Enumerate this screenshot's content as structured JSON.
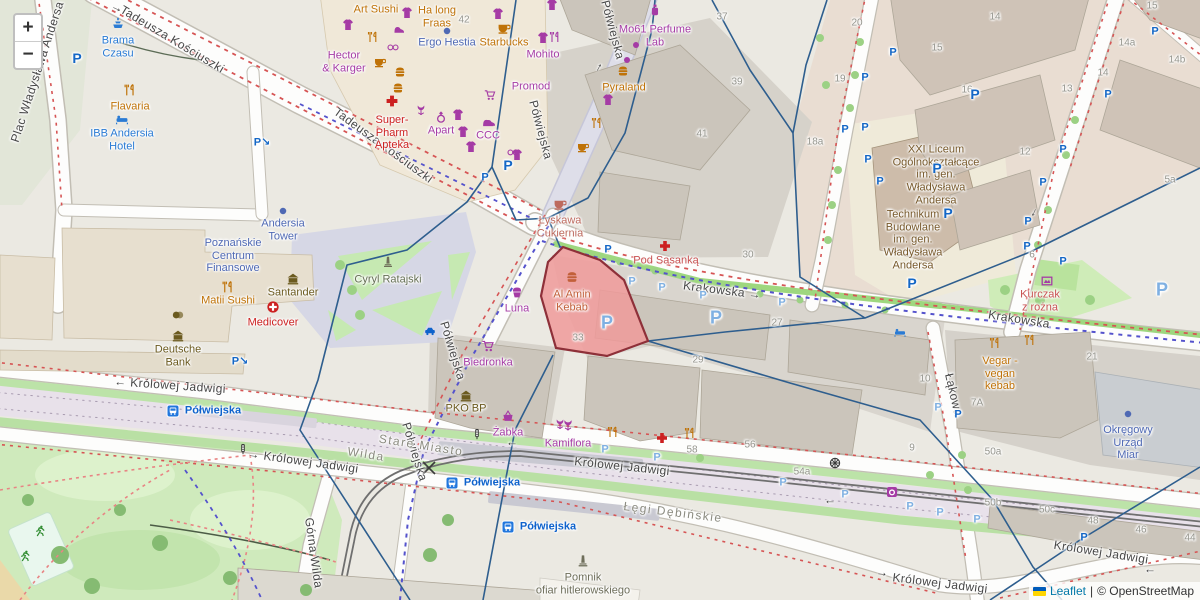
{
  "controls": {
    "zoom_in": "+",
    "zoom_out": "−"
  },
  "attribution": {
    "leaflet": "Leaflet",
    "separator": "|",
    "osm": "© OpenStreetMap",
    "flag_top": "#005bbb",
    "flag_bottom": "#ffd500"
  },
  "colors": {
    "shop": "#a53ba5",
    "food": "#bf7207",
    "health": "#cc2020",
    "hotel": "#2a7bd4",
    "attraction": "#2a7bd4",
    "office": "#4f69b4",
    "bank": "#6b5a1f",
    "school": "#77592b",
    "monument": "#6e6e5a",
    "transit": "#0e62cc",
    "plaza": "#667055",
    "resto2": "#c85252",
    "kebab": "#c2603a",
    "confection": "#bd6a5e",
    "parkfit": "#2e8b2e",
    "dark": "#3a3a3a",
    "street_label": "#474747",
    "district_label": "#8b8b80",
    "housenum": "#95958d",
    "parking": "#1467c6",
    "parking_light": "#7fb0e2",
    "boundary": "#2e5e8e",
    "highlight_fill": "#f09a9a",
    "highlight_stroke": "#8e3039",
    "route_red": "#d65454",
    "route_blue": "#5452cc"
  },
  "streets": [
    {
      "t": "Plac Władysława Andersa",
      "x": 38,
      "y": 72,
      "r": -72
    },
    {
      "t": "Tadeusza Kościuszki",
      "x": 172,
      "y": 40,
      "r": 31
    },
    {
      "t": "Tadeusza Kościuszki",
      "x": 383,
      "y": 146,
      "r": 36
    },
    {
      "t": "Półwiejska",
      "x": 612,
      "y": 30,
      "r": 75
    },
    {
      "t": "Półwiejska",
      "x": 540,
      "y": 130,
      "r": 75
    },
    {
      "t": "Krakowska →",
      "x": 722,
      "y": 291,
      "r": 7
    },
    {
      "t": "Krakowska",
      "x": 1019,
      "y": 320,
      "r": 9
    },
    {
      "t": "← Królowej Jadwigi",
      "x": 170,
      "y": 386,
      "r": 4
    },
    {
      "t": "→ Królowej Jadwigi",
      "x": 303,
      "y": 462,
      "r": 8
    },
    {
      "t": "Królowej Jadwigi",
      "x": 622,
      "y": 467,
      "r": 6
    },
    {
      "t": "Królowej Jadwigi",
      "x": 940,
      "y": 584,
      "r": 7
    },
    {
      "t": "Królowej Jadwigi",
      "x": 1101,
      "y": 553,
      "r": 9
    },
    {
      "t": "Półwiejska",
      "x": 452,
      "y": 351,
      "r": 73
    },
    {
      "t": "Półwiejska",
      "x": 414,
      "y": 452,
      "r": 73
    },
    {
      "t": "Łąkowa",
      "x": 953,
      "y": 395,
      "r": 77
    },
    {
      "t": "Górna Wilda",
      "x": 313,
      "y": 553,
      "r": 82
    }
  ],
  "districts": [
    {
      "t": "Stare Miasto",
      "x": 421,
      "y": 446,
      "r": 9
    },
    {
      "t": "Wilda",
      "x": 366,
      "y": 455,
      "r": 9
    },
    {
      "t": "Łęgi Dębińskie",
      "x": 673,
      "y": 513,
      "r": 7
    }
  ],
  "transit_stops": [
    {
      "t": "Półwiejska",
      "x": 213,
      "y": 411
    },
    {
      "t": "Półwiejska",
      "x": 492,
      "y": 483
    },
    {
      "t": "Półwiejska",
      "x": 548,
      "y": 527
    }
  ],
  "pois": [
    {
      "n": "Brama\nCzasu",
      "x": 118,
      "y": 47,
      "c": "attraction",
      "i": "fountain",
      "iy": -24
    },
    {
      "n": "Flavaria",
      "x": 130,
      "y": 107,
      "c": "food",
      "i": "cutlery",
      "iy": -17
    },
    {
      "n": "IBB Andersia\nHotel",
      "x": 122,
      "y": 140,
      "c": "hotel",
      "i": "bed",
      "iy": -21
    },
    {
      "n": "Art Sushi",
      "x": 376,
      "y": 10,
      "c": "food"
    },
    {
      "n": "Ha long\nFraas",
      "x": 437,
      "y": 17,
      "c": "food"
    },
    {
      "n": "Ergo Hestia",
      "x": 447,
      "y": 43,
      "c": "office",
      "i": "dot",
      "iy": -12
    },
    {
      "n": "Starbucks",
      "x": 504,
      "y": 43,
      "c": "food",
      "i": "cup",
      "iy": -15
    },
    {
      "n": "Mohito",
      "x": 543,
      "y": 55,
      "c": "shop"
    },
    {
      "n": "Hector\n& Karger",
      "x": 344,
      "y": 62,
      "c": "shop"
    },
    {
      "n": "Promod",
      "x": 531,
      "y": 87,
      "c": "shop"
    },
    {
      "n": "Super-\nPharm\nApteka",
      "x": 392,
      "y": 133,
      "c": "health",
      "i": "cross",
      "iy": -32
    },
    {
      "n": "Apart",
      "x": 441,
      "y": 131,
      "c": "shop",
      "i": "ring",
      "iy": -14
    },
    {
      "n": "CCC",
      "x": 488,
      "y": 136,
      "c": "shop",
      "i": "shoe",
      "iy": -14
    },
    {
      "n": "Mo61 Perfume\nLab",
      "x": 655,
      "y": 36,
      "c": "shop",
      "i": "perfume",
      "iy": -26
    },
    {
      "n": "Pyraland",
      "x": 624,
      "y": 88,
      "c": "food"
    },
    {
      "n": "Łyskawa\nCukiernia",
      "x": 560,
      "y": 227,
      "c": "confection",
      "i": "cup",
      "iy": -23
    },
    {
      "n": "Pod Sasanką",
      "x": 666,
      "y": 261,
      "c": "resto2"
    },
    {
      "n": "Al Amin\nKebab",
      "x": 572,
      "y": 301,
      "c": "kebab",
      "i": "burger",
      "iy": -24
    },
    {
      "n": "Luna",
      "x": 517,
      "y": 309,
      "c": "shop",
      "i": "cupcake",
      "iy": -17
    },
    {
      "n": "Biedronka",
      "x": 488,
      "y": 363,
      "c": "shop",
      "i": "cart",
      "iy": -17
    },
    {
      "n": "PKO BP",
      "x": 466,
      "y": 409,
      "c": "bank",
      "i": "bank",
      "iy": -13
    },
    {
      "n": "Żabka",
      "x": 508,
      "y": 433,
      "c": "shop",
      "i": "basket",
      "iy": -17
    },
    {
      "n": "Kamiflora",
      "x": 568,
      "y": 444,
      "c": "shop",
      "i": "tulip",
      "iy": -19
    },
    {
      "n": "Andersia\nTower",
      "x": 283,
      "y": 230,
      "c": "office",
      "i": "dot",
      "iy": -19
    },
    {
      "n": "Poznańskie\nCentrum\nFinansowe",
      "x": 233,
      "y": 256,
      "c": "office"
    },
    {
      "n": "Matii Sushi",
      "x": 228,
      "y": 301,
      "c": "food",
      "i": "cutlery",
      "iy": -14
    },
    {
      "n": "Santander",
      "x": 293,
      "y": 293,
      "c": "bank",
      "i": "bank",
      "iy": -14
    },
    {
      "n": "Medicover",
      "x": 273,
      "y": 323,
      "c": "health",
      "i": "clinic",
      "iy": -16
    },
    {
      "n": "Deutsche\nBank",
      "x": 178,
      "y": 356,
      "c": "bank",
      "i": "bank",
      "iy": -20
    },
    {
      "n": "Cyryl Ratajski",
      "x": 388,
      "y": 280,
      "c": "plaza"
    },
    {
      "n": "XXI Liceum\nOgólnokształcące\nim. gen.\nWładysława\nAndersa",
      "x": 936,
      "y": 175,
      "c": "school"
    },
    {
      "n": "Technikum\nBudowlane\nim. gen.\nWładysława\nAndersa",
      "x": 913,
      "y": 240,
      "c": "school"
    },
    {
      "n": "Kurczak\nz rożna",
      "x": 1040,
      "y": 301,
      "c": "resto2"
    },
    {
      "n": "Vegar -\nvegan\nkebab",
      "x": 1000,
      "y": 374,
      "c": "food"
    },
    {
      "n": "Okręgowy\nUrząd\nMiar",
      "x": 1128,
      "y": 443,
      "c": "office",
      "i": "dot",
      "iy": -29
    },
    {
      "n": "Pomnik\nofiar hitlerowskiego",
      "x": 583,
      "y": 584,
      "c": "monument",
      "i": "monument",
      "iy": -23
    }
  ],
  "deco_icons": [
    {
      "x": 348,
      "y": 25,
      "i": "tshirt",
      "c": "shop"
    },
    {
      "x": 407,
      "y": 13,
      "i": "tshirt",
      "c": "shop"
    },
    {
      "x": 498,
      "y": 14,
      "i": "tshirt",
      "c": "shop"
    },
    {
      "x": 552,
      "y": 5,
      "i": "tshirt",
      "c": "shop"
    },
    {
      "x": 543,
      "y": 38,
      "i": "tshirt",
      "c": "shop"
    },
    {
      "x": 458,
      "y": 115,
      "i": "tshirt",
      "c": "shop"
    },
    {
      "x": 463,
      "y": 132,
      "i": "tshirt",
      "c": "shop"
    },
    {
      "x": 471,
      "y": 147,
      "i": "tshirt",
      "c": "shop"
    },
    {
      "x": 608,
      "y": 100,
      "i": "tshirt",
      "c": "shop"
    },
    {
      "x": 517,
      "y": 155,
      "i": "tshirt",
      "c": "shop"
    },
    {
      "x": 555,
      "y": 37,
      "i": "cutlery",
      "c": "shop"
    },
    {
      "x": 399,
      "y": 29,
      "i": "shoe",
      "c": "shop"
    },
    {
      "x": 490,
      "y": 122,
      "i": "shoe",
      "c": "shop"
    },
    {
      "x": 393,
      "y": 47,
      "i": "glasses",
      "c": "shop"
    },
    {
      "x": 513,
      "y": 152,
      "i": "glasses",
      "c": "shop"
    },
    {
      "x": 490,
      "y": 95,
      "i": "cart",
      "c": "shop"
    },
    {
      "x": 400,
      "y": 72,
      "i": "burger",
      "c": "food"
    },
    {
      "x": 398,
      "y": 88,
      "i": "burger",
      "c": "food"
    },
    {
      "x": 623,
      "y": 71,
      "i": "burger",
      "c": "food"
    },
    {
      "x": 373,
      "y": 37,
      "i": "cutlery",
      "c": "food"
    },
    {
      "x": 597,
      "y": 123,
      "i": "cutlery",
      "c": "food"
    },
    {
      "x": 995,
      "y": 343,
      "i": "cutlery",
      "c": "food"
    },
    {
      "x": 1030,
      "y": 340,
      "i": "cutlery",
      "c": "food"
    },
    {
      "x": 613,
      "y": 432,
      "i": "cutlery",
      "c": "food"
    },
    {
      "x": 690,
      "y": 433,
      "i": "cutlery",
      "c": "food"
    },
    {
      "x": 380,
      "y": 62,
      "i": "cup",
      "c": "food"
    },
    {
      "x": 583,
      "y": 147,
      "i": "cup",
      "c": "food"
    },
    {
      "x": 665,
      "y": 246,
      "i": "cross",
      "c": "health"
    },
    {
      "x": 662,
      "y": 438,
      "i": "cross",
      "c": "health"
    },
    {
      "x": 421,
      "y": 110,
      "i": "tulip",
      "c": "shop"
    },
    {
      "x": 560,
      "y": 424,
      "i": "tulip",
      "c": "shop"
    },
    {
      "x": 636,
      "y": 45,
      "i": "dot",
      "c": "shop"
    },
    {
      "x": 627,
      "y": 60,
      "i": "dot",
      "c": "shop"
    },
    {
      "x": 178,
      "y": 315,
      "i": "money",
      "c": "bank"
    },
    {
      "x": 900,
      "y": 332,
      "i": "bed",
      "c": "hotel"
    },
    {
      "x": 430,
      "y": 331,
      "i": "taxi",
      "c": "transit"
    },
    {
      "x": 835,
      "y": 463,
      "i": "wheel",
      "c": "dark"
    },
    {
      "x": 892,
      "y": 492,
      "i": "laundry",
      "c": "shop"
    },
    {
      "x": 1047,
      "y": 281,
      "i": "artwork",
      "c": "shop"
    },
    {
      "x": 40,
      "y": 531,
      "i": "runner",
      "c": "parkfit"
    },
    {
      "x": 25,
      "y": 556,
      "i": "runner",
      "c": "parkfit"
    },
    {
      "x": 477,
      "y": 434,
      "i": "tlight",
      "c": "dark"
    },
    {
      "x": 243,
      "y": 449,
      "i": "tlight",
      "c": "dark"
    },
    {
      "x": 388,
      "y": 262,
      "i": "monument",
      "c": "monument"
    }
  ],
  "parking": {
    "glyph": "P",
    "entry_glyph": "P↘",
    "items": [
      {
        "x": 77,
        "y": 58,
        "s": "b"
      },
      {
        "x": 975,
        "y": 94,
        "s": "b"
      },
      {
        "x": 937,
        "y": 168,
        "s": "b"
      },
      {
        "x": 912,
        "y": 283,
        "s": "b"
      },
      {
        "x": 948,
        "y": 213,
        "s": "b"
      },
      {
        "x": 508,
        "y": 165,
        "s": "b"
      },
      {
        "x": 607,
        "y": 323,
        "s": "b",
        "l": 1
      },
      {
        "x": 716,
        "y": 318,
        "s": "b",
        "l": 1
      },
      {
        "x": 1162,
        "y": 290,
        "s": "b",
        "l": 1
      },
      {
        "x": 865,
        "y": 78
      },
      {
        "x": 893,
        "y": 53
      },
      {
        "x": 865,
        "y": 128
      },
      {
        "x": 1108,
        "y": 95
      },
      {
        "x": 1063,
        "y": 150
      },
      {
        "x": 1155,
        "y": 32
      },
      {
        "x": 880,
        "y": 182
      },
      {
        "x": 845,
        "y": 130
      },
      {
        "x": 868,
        "y": 160
      },
      {
        "x": 1043,
        "y": 183
      },
      {
        "x": 1028,
        "y": 222
      },
      {
        "x": 1027,
        "y": 247
      },
      {
        "x": 1063,
        "y": 262
      },
      {
        "x": 608,
        "y": 250
      },
      {
        "x": 958,
        "y": 415
      },
      {
        "x": 1084,
        "y": 538
      },
      {
        "x": 485,
        "y": 178
      },
      {
        "x": 632,
        "y": 282,
        "l": 1
      },
      {
        "x": 662,
        "y": 288,
        "l": 1
      },
      {
        "x": 703,
        "y": 296,
        "l": 1
      },
      {
        "x": 782,
        "y": 303,
        "l": 1
      },
      {
        "x": 605,
        "y": 450,
        "l": 1
      },
      {
        "x": 657,
        "y": 458,
        "l": 1
      },
      {
        "x": 783,
        "y": 483,
        "l": 1
      },
      {
        "x": 845,
        "y": 495,
        "l": 1
      },
      {
        "x": 910,
        "y": 507,
        "l": 1
      },
      {
        "x": 940,
        "y": 513,
        "l": 1
      },
      {
        "x": 977,
        "y": 520,
        "l": 1
      },
      {
        "x": 938,
        "y": 408,
        "l": 1
      }
    ],
    "entries": [
      {
        "x": 262,
        "y": 143
      },
      {
        "x": 240,
        "y": 362
      }
    ]
  },
  "house_numbers": [
    {
      "t": "42",
      "x": 464,
      "y": 20
    },
    {
      "t": "37",
      "x": 722,
      "y": 17
    },
    {
      "t": "39",
      "x": 737,
      "y": 82
    },
    {
      "t": "41",
      "x": 702,
      "y": 134
    },
    {
      "t": "20",
      "x": 857,
      "y": 23
    },
    {
      "t": "19",
      "x": 840,
      "y": 79
    },
    {
      "t": "18a",
      "x": 815,
      "y": 142
    },
    {
      "t": "14",
      "x": 995,
      "y": 17
    },
    {
      "t": "15",
      "x": 1152,
      "y": 6
    },
    {
      "t": "15",
      "x": 937,
      "y": 48
    },
    {
      "t": "16",
      "x": 967,
      "y": 90
    },
    {
      "t": "13",
      "x": 1067,
      "y": 89
    },
    {
      "t": "14a",
      "x": 1127,
      "y": 43
    },
    {
      "t": "14",
      "x": 1103,
      "y": 73
    },
    {
      "t": "14b",
      "x": 1177,
      "y": 60
    },
    {
      "t": "12",
      "x": 1025,
      "y": 152
    },
    {
      "t": "6",
      "x": 1032,
      "y": 255
    },
    {
      "t": "5a",
      "x": 1170,
      "y": 180
    },
    {
      "t": "30",
      "x": 748,
      "y": 255
    },
    {
      "t": "27",
      "x": 777,
      "y": 323
    },
    {
      "t": "29",
      "x": 698,
      "y": 360
    },
    {
      "t": "33",
      "x": 578,
      "y": 338
    },
    {
      "t": "10",
      "x": 925,
      "y": 379
    },
    {
      "t": "56",
      "x": 750,
      "y": 445
    },
    {
      "t": "58",
      "x": 692,
      "y": 450
    },
    {
      "t": "54a",
      "x": 802,
      "y": 472
    },
    {
      "t": "9",
      "x": 912,
      "y": 448
    },
    {
      "t": "50a",
      "x": 993,
      "y": 452
    },
    {
      "t": "50b",
      "x": 993,
      "y": 503
    },
    {
      "t": "50c",
      "x": 1047,
      "y": 510
    },
    {
      "t": "7A",
      "x": 977,
      "y": 403
    },
    {
      "t": "48",
      "x": 1093,
      "y": 521
    },
    {
      "t": "46",
      "x": 1141,
      "y": 530
    },
    {
      "t": "44",
      "x": 1190,
      "y": 538
    },
    {
      "t": "21",
      "x": 1092,
      "y": 357
    }
  ],
  "street_arrows": [
    {
      "g": "→",
      "x": 117,
      "y": 8,
      "r": 25
    },
    {
      "g": "→",
      "x": 598,
      "y": 67,
      "r": -62
    },
    {
      "g": "→",
      "x": 1035,
      "y": 213,
      "r": 115
    },
    {
      "g": "→",
      "x": 512,
      "y": 445,
      "r": 180
    },
    {
      "g": "→",
      "x": 830,
      "y": 503,
      "r": 180
    },
    {
      "g": "→",
      "x": 882,
      "y": 573,
      "r": 5
    },
    {
      "g": "→",
      "x": 1150,
      "y": 572,
      "r": 180
    }
  ]
}
